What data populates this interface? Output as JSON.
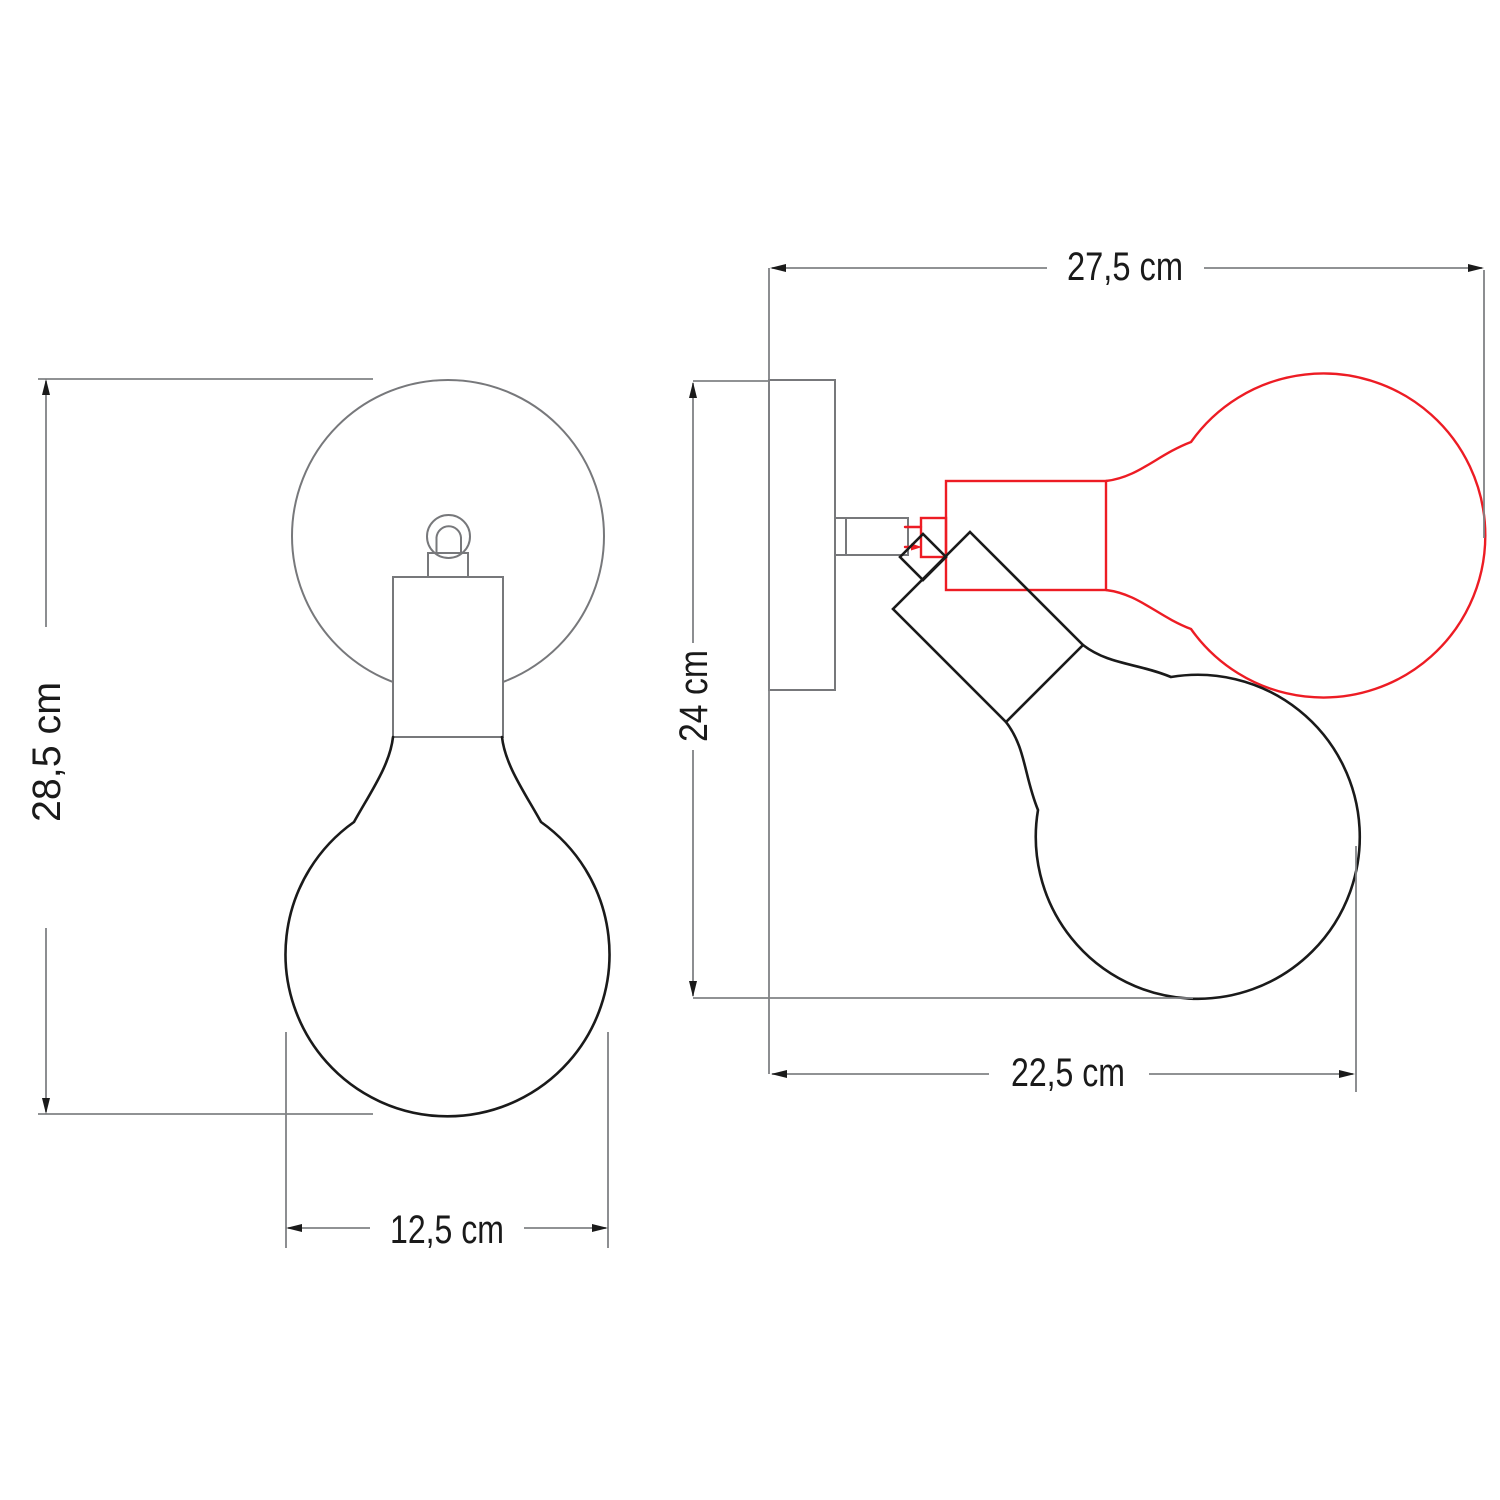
{
  "drawing": {
    "type": "technical-dimension-drawing",
    "subject": "adjustable wall lamp with globe bulb, front and side views",
    "views": {
      "front": {
        "dimensions": {
          "height": "28,5 cm",
          "width": "12,5 cm"
        }
      },
      "side": {
        "dimensions": {
          "total_width": "27,5 cm",
          "height": "24 cm",
          "projection": "22,5 cm"
        }
      }
    },
    "colors": {
      "structure": "#77787b",
      "bulb_outline": "#1a1a1a",
      "alternate_position": "#ed1c24",
      "dimension_line": "#808285",
      "text": "#1a1a1a",
      "background": "#ffffff"
    }
  }
}
